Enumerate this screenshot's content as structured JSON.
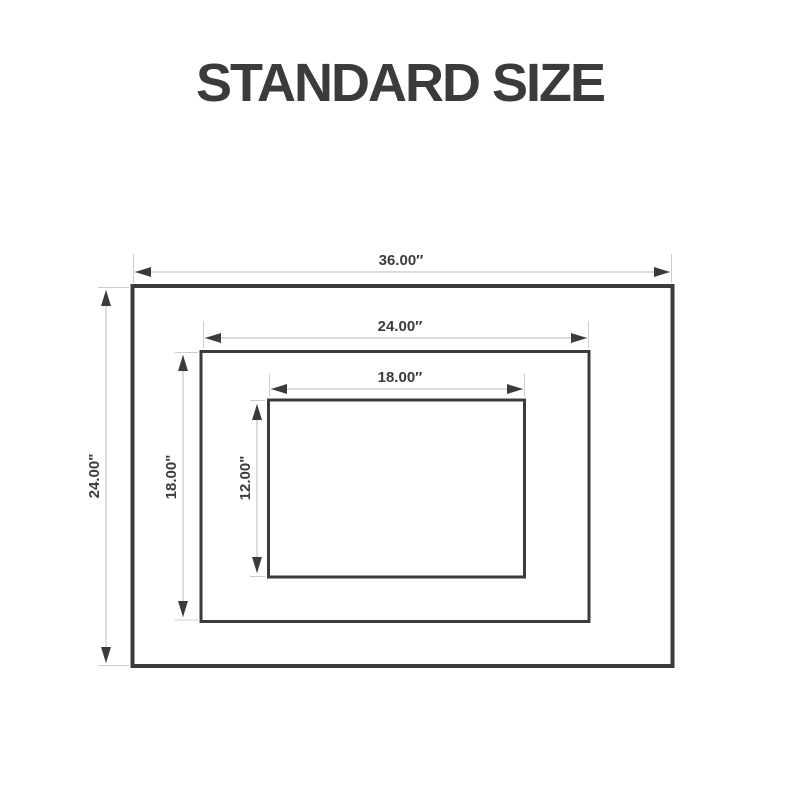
{
  "title": "STANDARD SIZE",
  "colors": {
    "ink": "#3b3b3d",
    "dimension_line": "#c6c6c6",
    "background": "#ffffff"
  },
  "diagram": {
    "rectangles": [
      {
        "id": "outer",
        "width_label": "36.00″",
        "height_label": "24.00\""
      },
      {
        "id": "middle",
        "width_label": "24.00″",
        "height_label": "18.00\""
      },
      {
        "id": "inner",
        "width_label": "18.00″",
        "height_label": "12.00\""
      }
    ]
  }
}
